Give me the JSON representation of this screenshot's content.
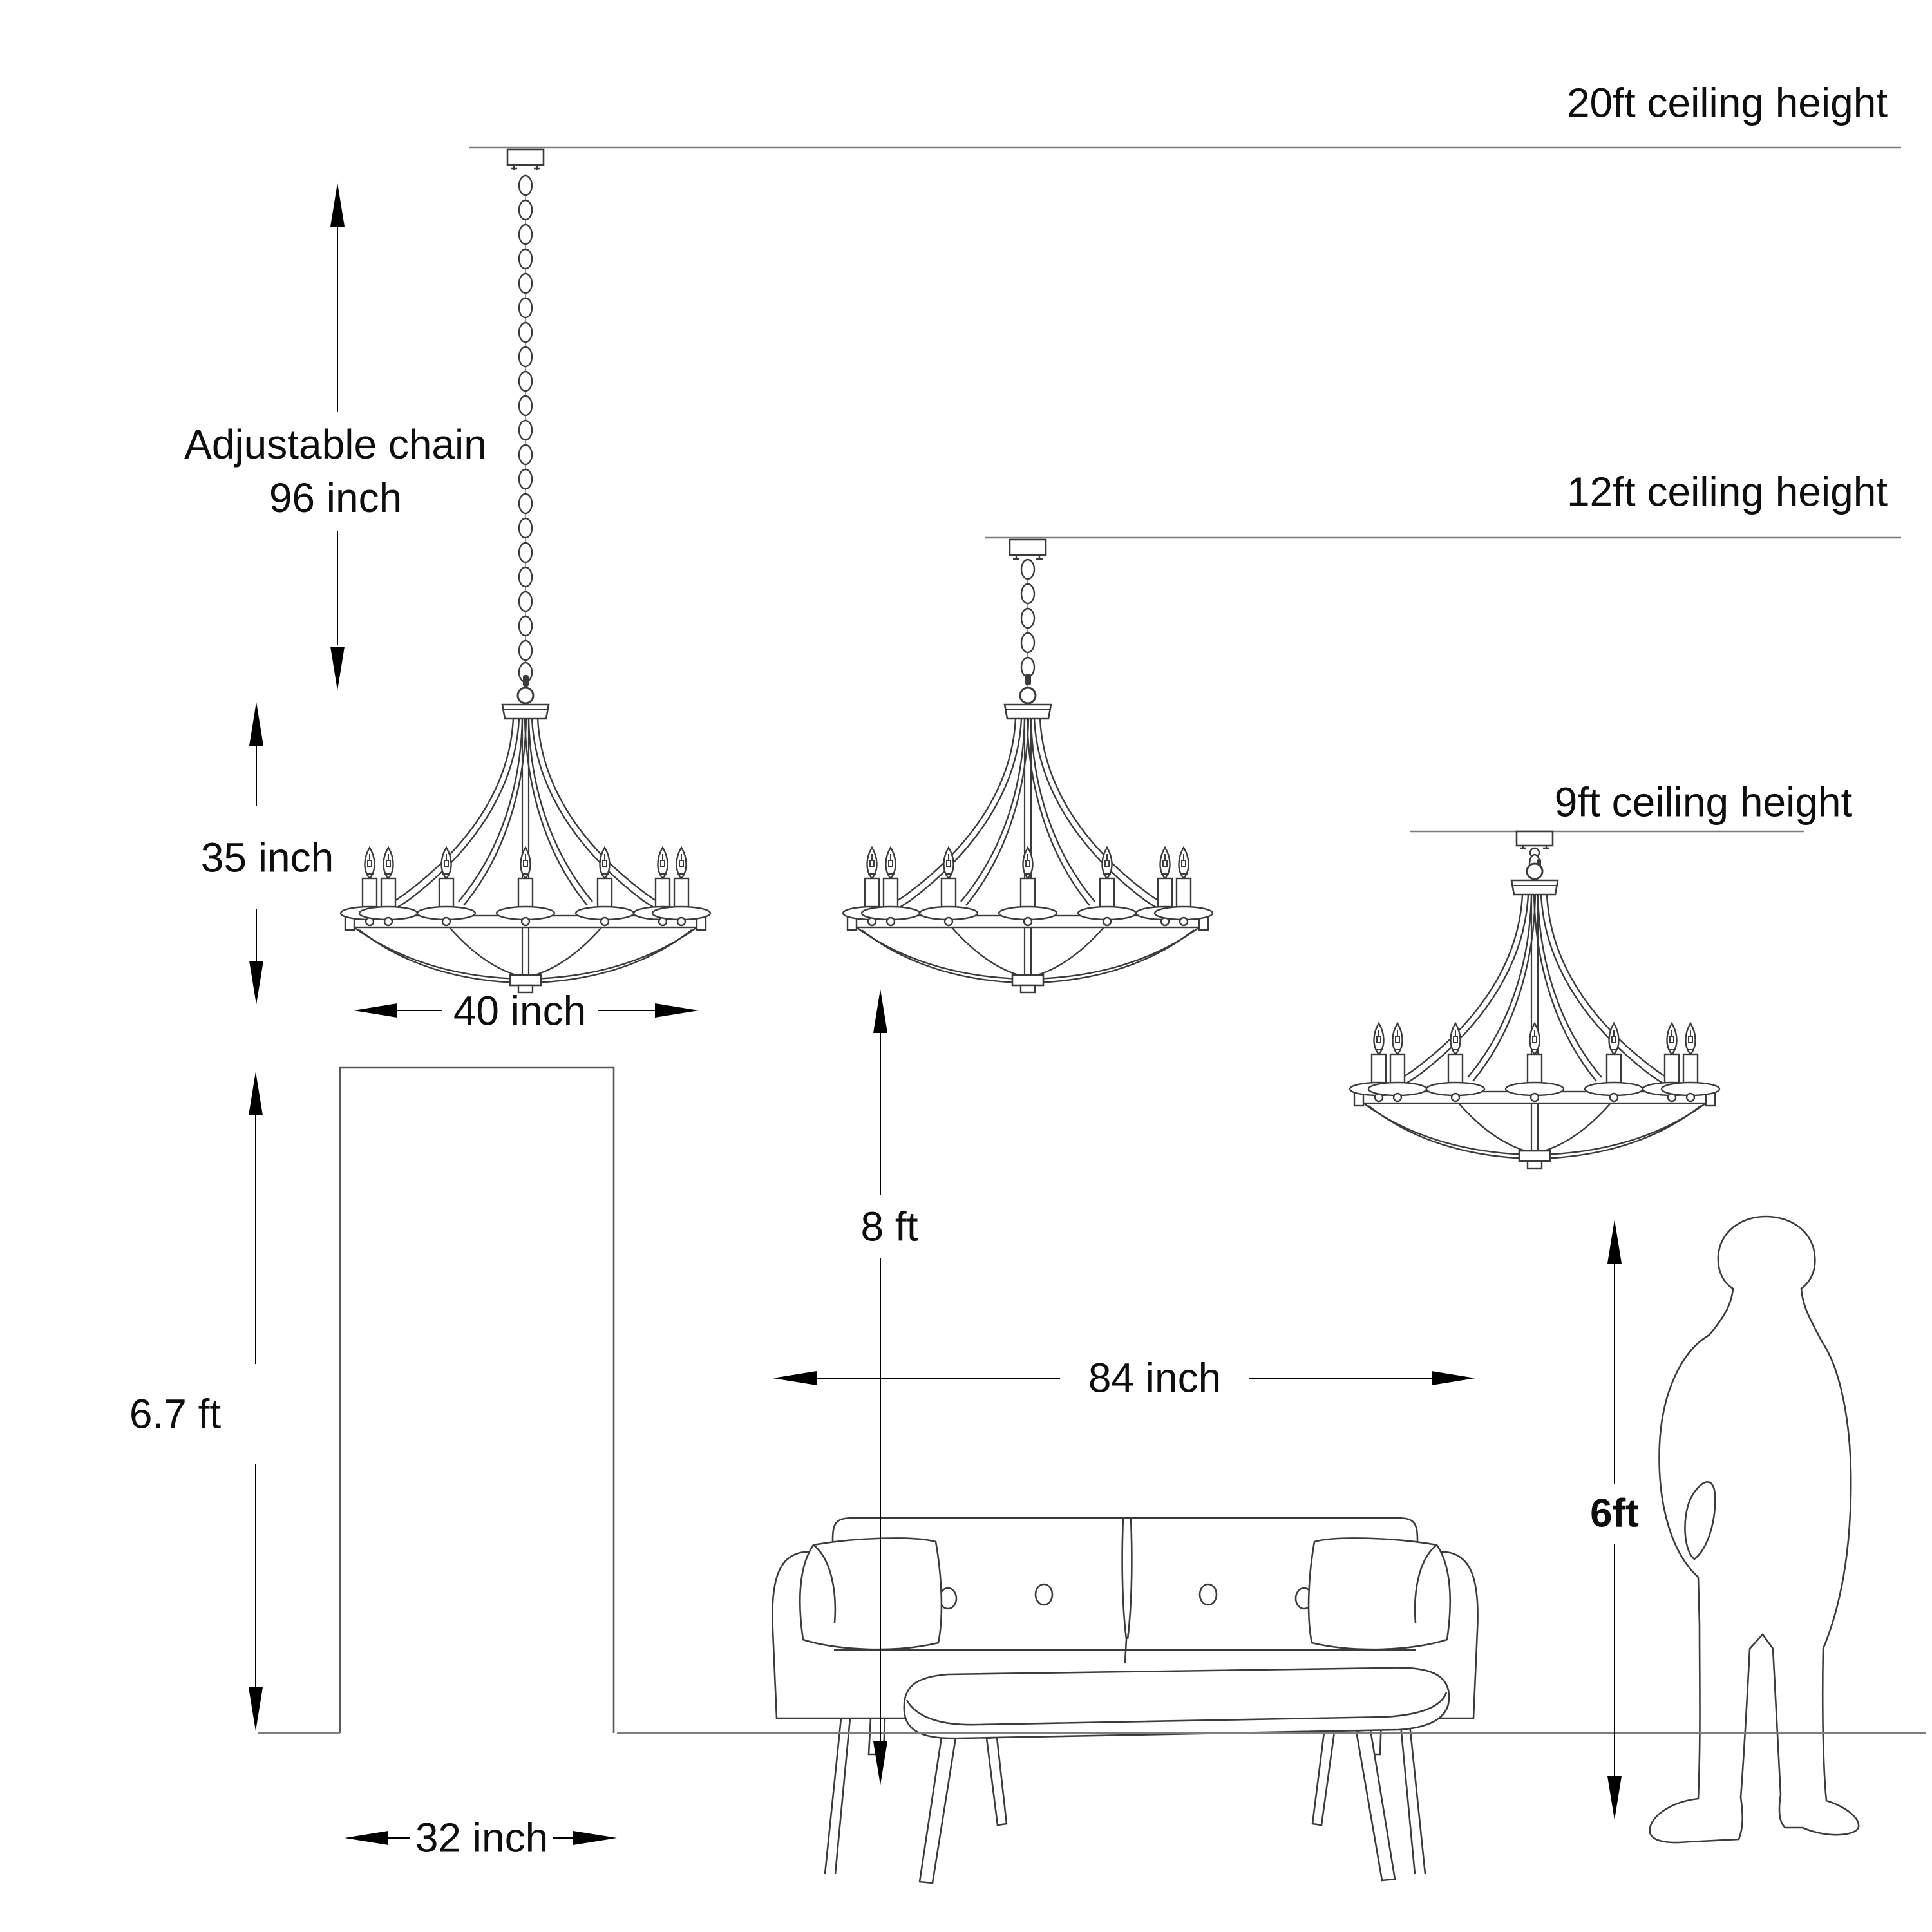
{
  "labels": {
    "ceiling_20ft": "20ft ceiling height",
    "ceiling_12ft": "12ft ceiling height",
    "ceiling_9ft": "9ft ceiling height",
    "chain_line1": "Adjustable chain",
    "chain_line2": "96 inch",
    "fixture_height": "35 inch",
    "fixture_width": "40 inch",
    "door_height": "6.7 ft",
    "door_width": "32 inch",
    "floor_to_fixture": "8 ft",
    "sofa_width": "84 inch",
    "person_height": "6ft"
  },
  "colors": {
    "line_art": "#3b3b3b",
    "dimension": "#000000",
    "guide_line": "#7d7d7d",
    "text": "#0e0e0e",
    "background": "#ffffff"
  }
}
